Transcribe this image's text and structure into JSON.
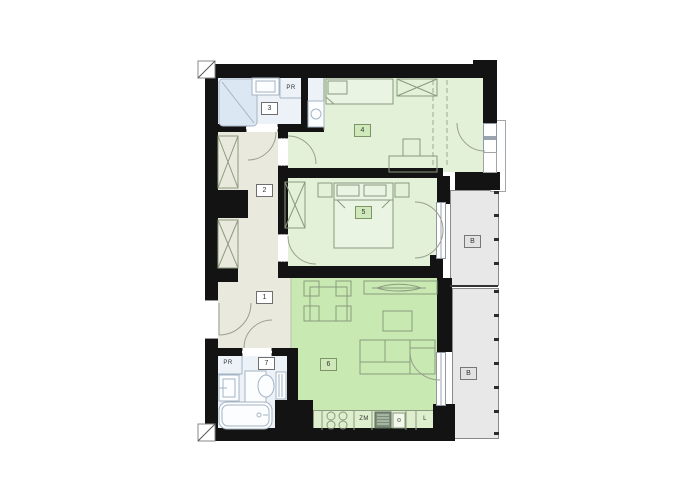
{
  "title": "apartment-floor-plan",
  "labels": {
    "hall_lower": "1",
    "hall_upper": "2",
    "bathroom_upper": "3",
    "bedroom_large": "4",
    "bedroom_small": "5",
    "living_room": "6",
    "bathroom_lower": "7",
    "balcony_upper": "B",
    "balcony_lower": "B",
    "wardrobe_upper": "PR",
    "wardrobe_lower": "PR",
    "dishwasher": "ZM",
    "fridge": "L"
  },
  "colors": {
    "wall": "#131313",
    "bedroom_fill": "#e3f1d9",
    "living_fill": "#c9e9b2",
    "hall_fill": "#e9eadd",
    "bath_fill": "#edf2f8",
    "balcony_fill": "#e8e8e8",
    "counter_fill": "#ddefcc",
    "label_green_fill": "#cfe9bb",
    "furniture_line": "#8a9a7e",
    "bath_line": "#a5b4c4"
  }
}
